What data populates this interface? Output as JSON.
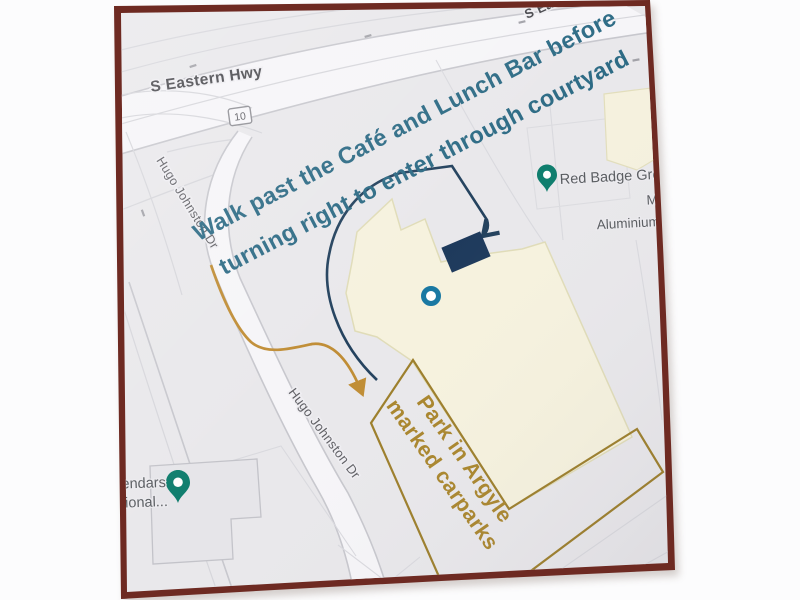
{
  "colors": {
    "frame_maroon": "#6e2a22",
    "map_background": "#e9e8eb",
    "annotation_blue_text": "#2d6b85",
    "arrow_blue": "#24425e",
    "entrance_block_navy": "#1e3a5c",
    "annotation_orange_text": "#a9852c",
    "arrow_orange": "#c08d35",
    "carpark_outline_gold": "#9c7e2a",
    "pin_teal_green": "#0e7d6d",
    "dot_marker_teal": "#1878a2",
    "building_cream": "#f6f2de"
  },
  "roads": {
    "highway_label": "S Eastern Hwy",
    "highway_label_clipped": "S Eas",
    "route_shield": "10",
    "street_label": "Hugo Johnston Dr",
    "street_label_2": "Hugo Johnston Dr"
  },
  "places": {
    "red_badge": "Red Badge Gro",
    "aluminium_line1": "M",
    "aluminium_line2": "Aluminium",
    "left_poi_line1": "endars",
    "left_poi_line2": "ional..."
  },
  "annotations": {
    "walk_note_line1": "Walk past the Café and Lunch Bar before",
    "walk_note_line2": "turning right to enter through courtyard",
    "park_note_line1": "Park in Argyle",
    "park_note_line2": "marked carparks"
  }
}
